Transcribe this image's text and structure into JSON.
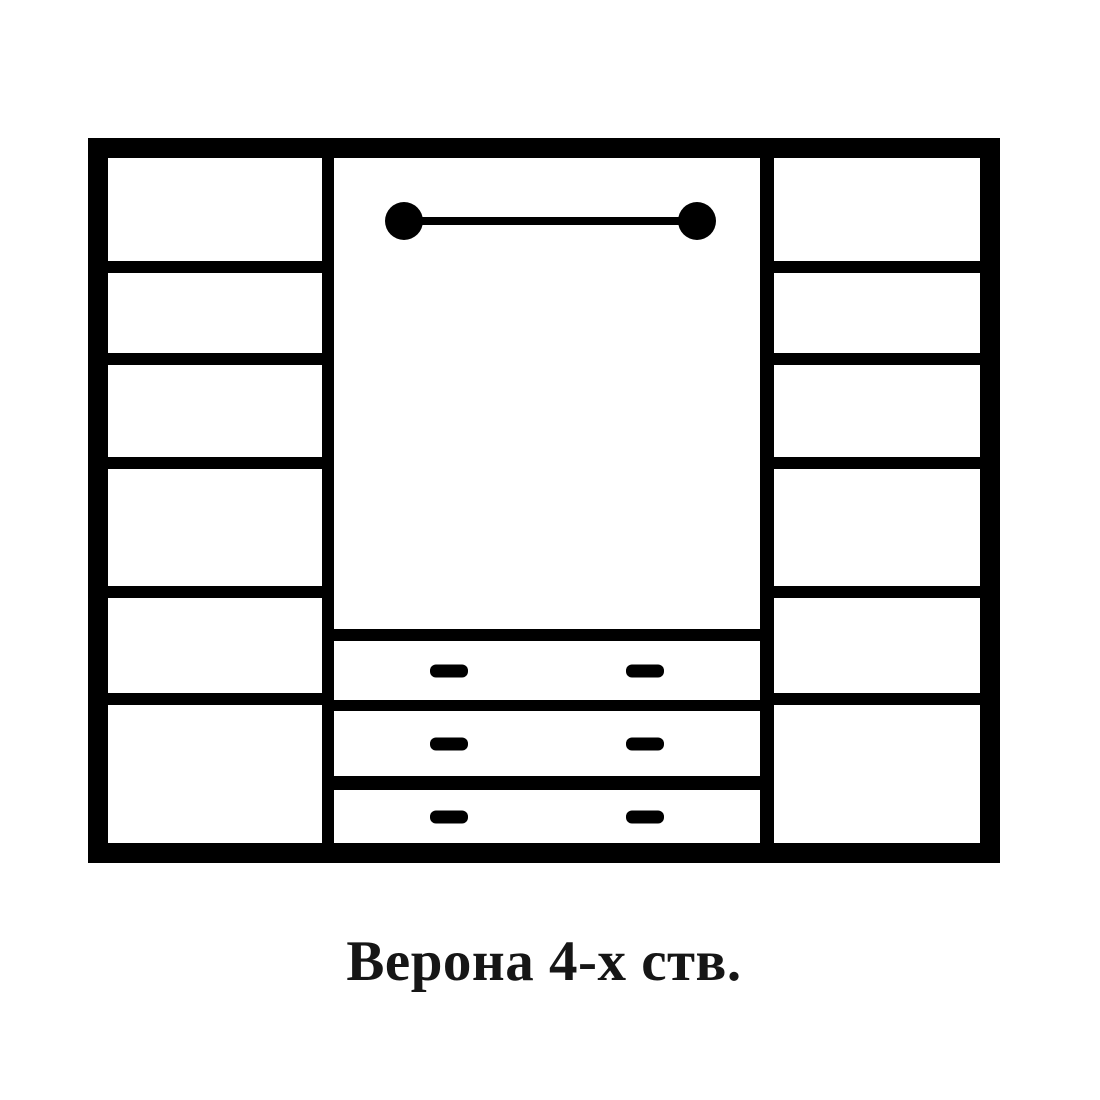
{
  "caption": {
    "text": "Верона 4-х ств."
  },
  "colors": {
    "line": "#000000",
    "background": "#ffffff",
    "caption_text": "#161616"
  },
  "diagram": {
    "type": "furniture-front-scheme",
    "subject": "wardrobe",
    "left_column": {
      "compartments": 6
    },
    "right_column": {
      "compartments": 6
    },
    "middle_section": {
      "hanging_rod": true,
      "drawers": 3,
      "handles_per_drawer": 2
    }
  }
}
